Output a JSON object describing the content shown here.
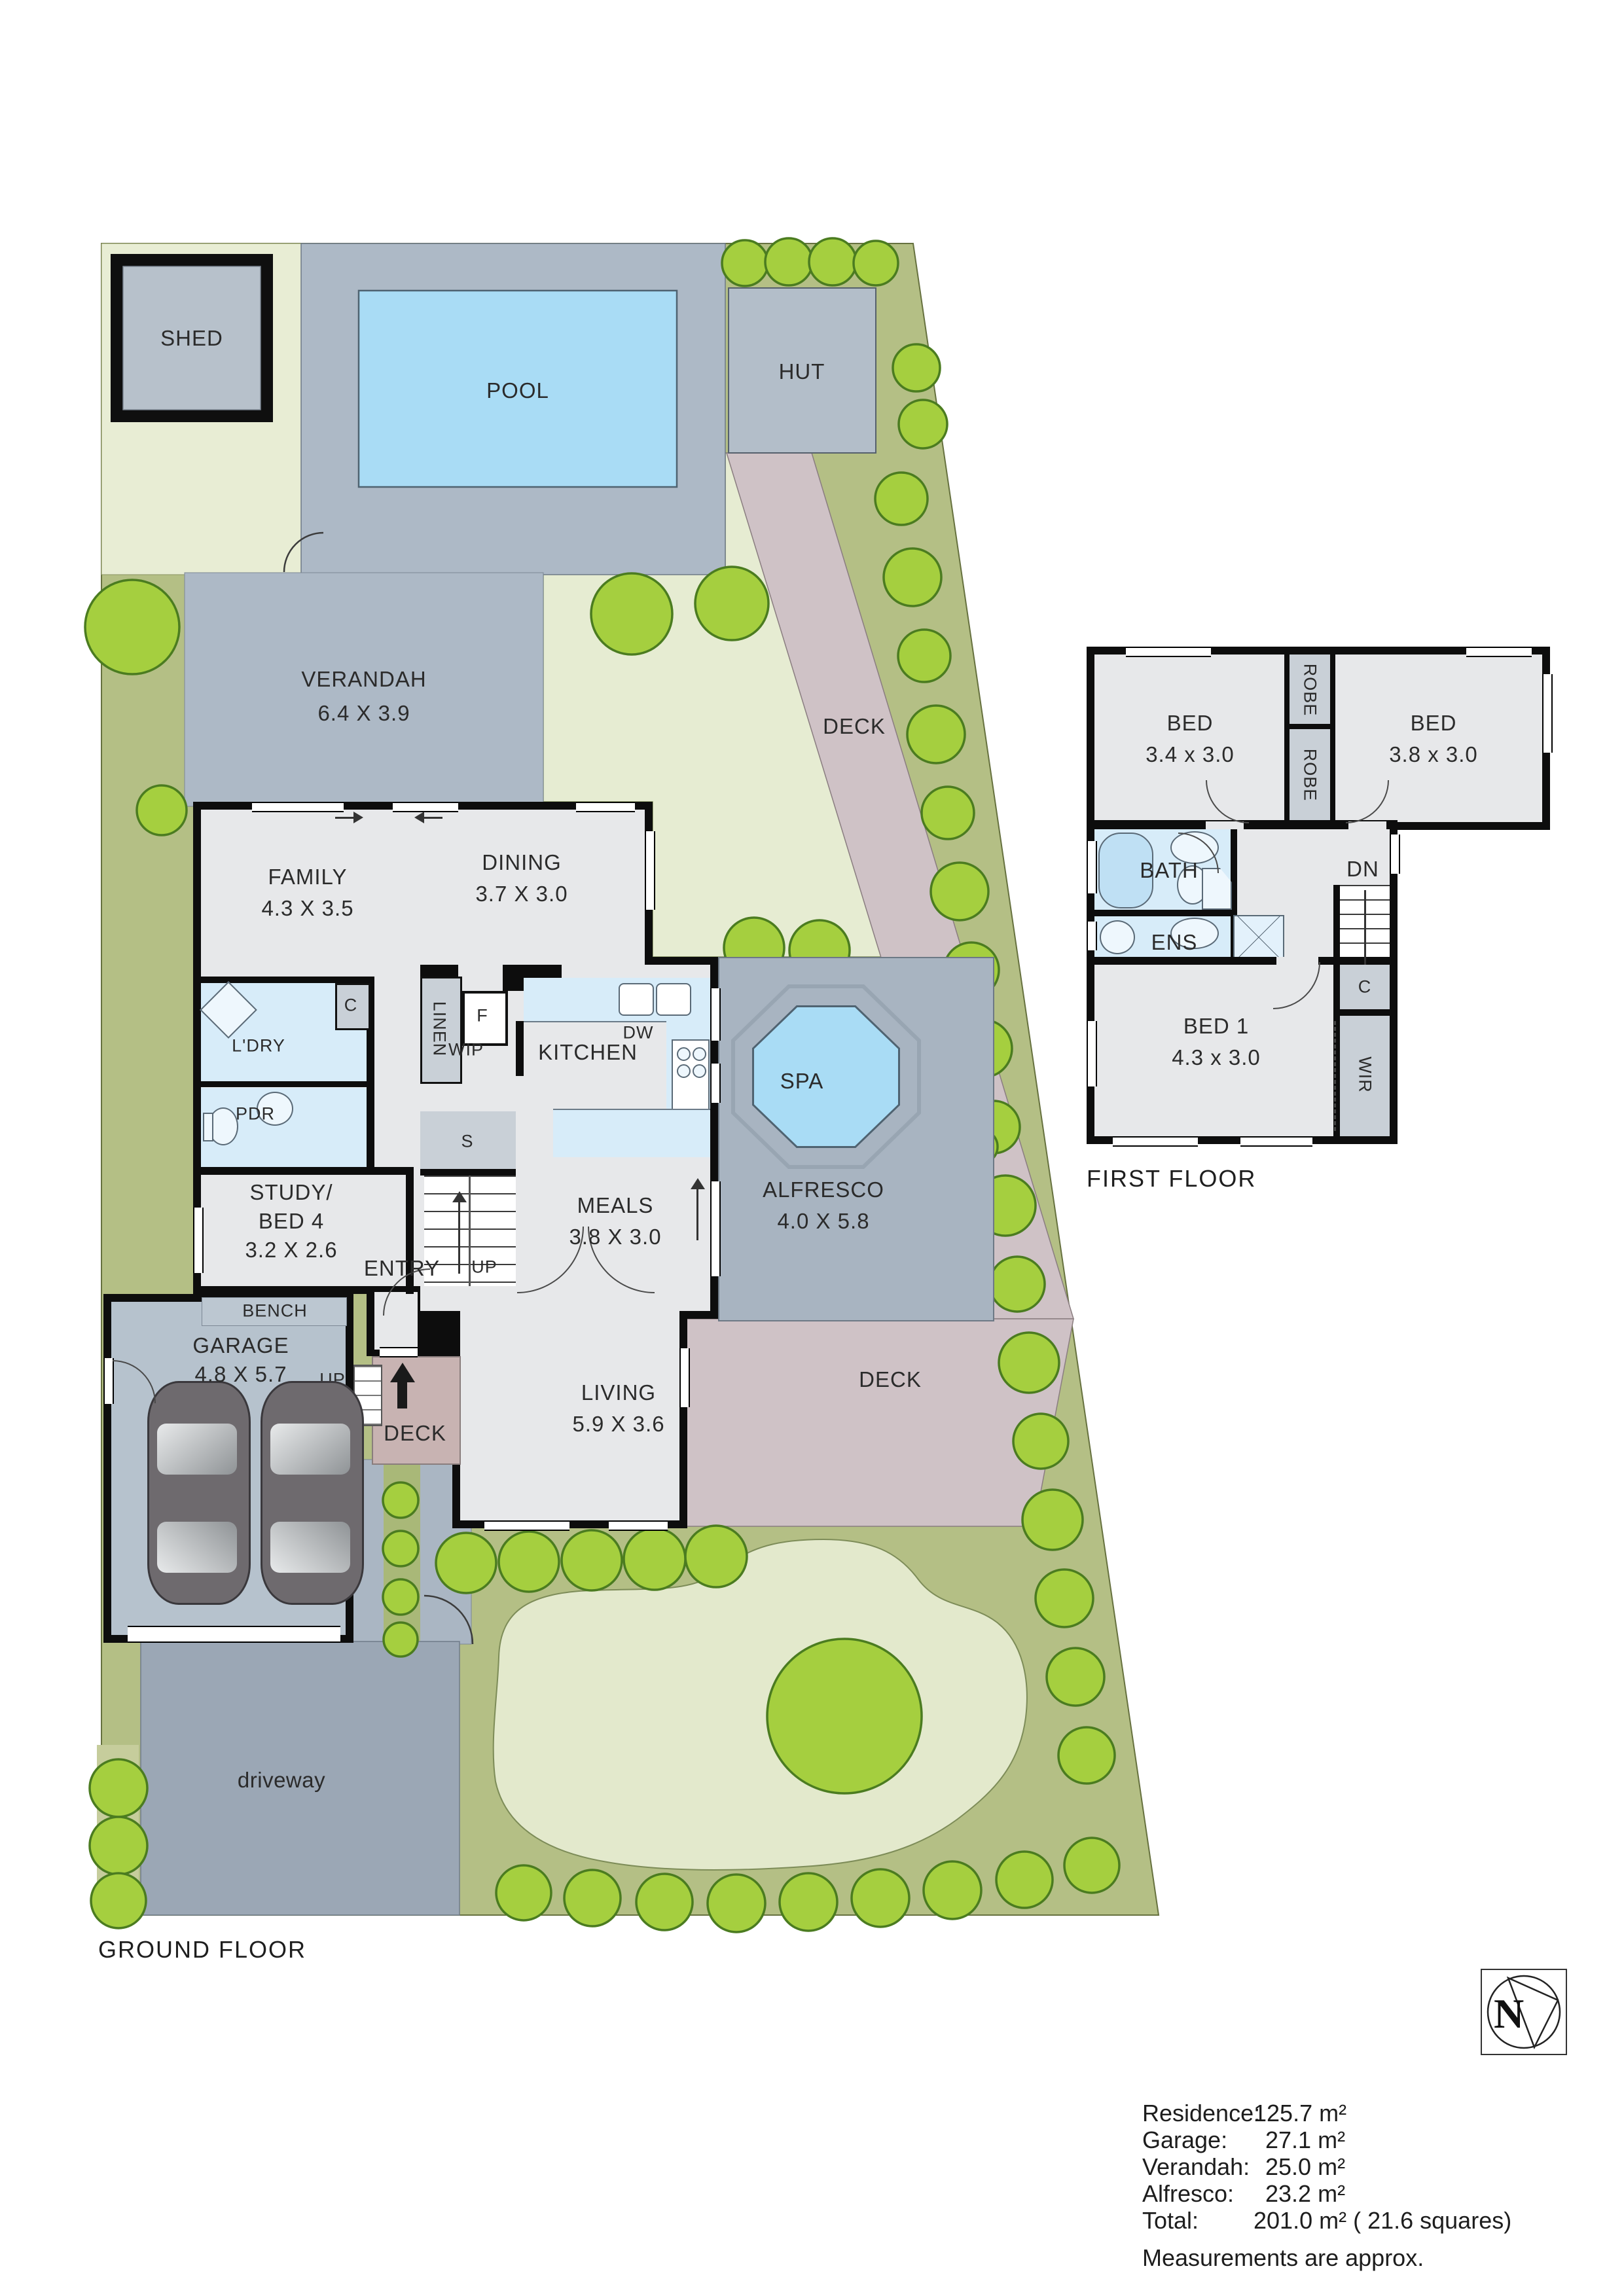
{
  "labels": {
    "ground_floor": "GROUND FLOOR",
    "first_floor": "FIRST FLOOR"
  },
  "site": {
    "shed": "SHED",
    "pool": "POOL",
    "hut": "HUT",
    "deck_path": "DECK",
    "deck_rear": "DECK",
    "deck_entry": "DECK",
    "driveway": "driveway",
    "up_steps": "UP",
    "up_stairs": "UP",
    "bench": "BENCH",
    "entry": "ENTRY"
  },
  "rooms": {
    "verandah": {
      "name": "VERANDAH",
      "dims": "6.4 X 3.9"
    },
    "family": {
      "name": "FAMILY",
      "dims": "4.3 X 3.5"
    },
    "dining": {
      "name": "DINING",
      "dims": "3.7 X 3.0"
    },
    "kitchen": {
      "name": "KITCHEN"
    },
    "meals": {
      "name": "MEALS",
      "dims": "3.8 X 3.0"
    },
    "living": {
      "name": "LIVING",
      "dims": "5.9 X 3.6"
    },
    "study": {
      "line1": "STUDY/",
      "line2": "BED 4",
      "dims": "3.2 X 2.6"
    },
    "garage": {
      "name": "GARAGE",
      "dims": "4.8 X 5.7"
    },
    "alfresco": {
      "name": "ALFRESCO",
      "dims": "4.0 X 5.8"
    },
    "spa": {
      "name": "SPA"
    },
    "laundry": {
      "name": "L'DRY"
    },
    "powder": {
      "name": "PDR"
    },
    "wip": {
      "name": "WIP"
    },
    "linen": {
      "name": "LINEN"
    },
    "fridge": {
      "name": "F"
    },
    "store": {
      "name": "S"
    },
    "closet": {
      "name": "C"
    },
    "dishwasher": {
      "name": "DW"
    }
  },
  "first_floor": {
    "bed_left": {
      "name": "BED",
      "dims": "3.4 x 3.0"
    },
    "bed_right": {
      "name": "BED",
      "dims": "3.8 x 3.0"
    },
    "bed1": {
      "name": "BED 1",
      "dims": "4.3 x 3.0"
    },
    "bath": {
      "name": "BATH"
    },
    "ens": {
      "name": "ENS"
    },
    "robe_upper": {
      "name": "ROBE"
    },
    "robe_lower": {
      "name": "ROBE"
    },
    "wir": {
      "name": "WIR"
    },
    "closet": {
      "name": "C"
    },
    "down": {
      "name": "DN"
    }
  },
  "areas": {
    "rows": [
      {
        "label": "Residence:",
        "value": "125.7 m²"
      },
      {
        "label": "Garage:",
        "value": "27.1 m²"
      },
      {
        "label": "Verandah:",
        "value": "25.0 m²"
      },
      {
        "label": "Alfresco:",
        "value": "23.2 m²"
      },
      {
        "label": "Total:",
        "value": "201.0 m² ( 21.6 squares)"
      }
    ],
    "note": "Measurements are approx."
  },
  "compass": {
    "label": "N"
  },
  "colors": {
    "lawn": "#e8edd4",
    "garden_bed": "#b4bf85",
    "tree": "#a5cf3f",
    "paving": "#adb9c6",
    "pool_water": "#a9dcf5",
    "deck": "#cfc2c6",
    "driveway": "#9ba7b5",
    "room": "#e7e8ea",
    "wet_area": "#d7ecf9",
    "wardrobe": "#c9d0d7",
    "wall": "#0d0d0d"
  }
}
